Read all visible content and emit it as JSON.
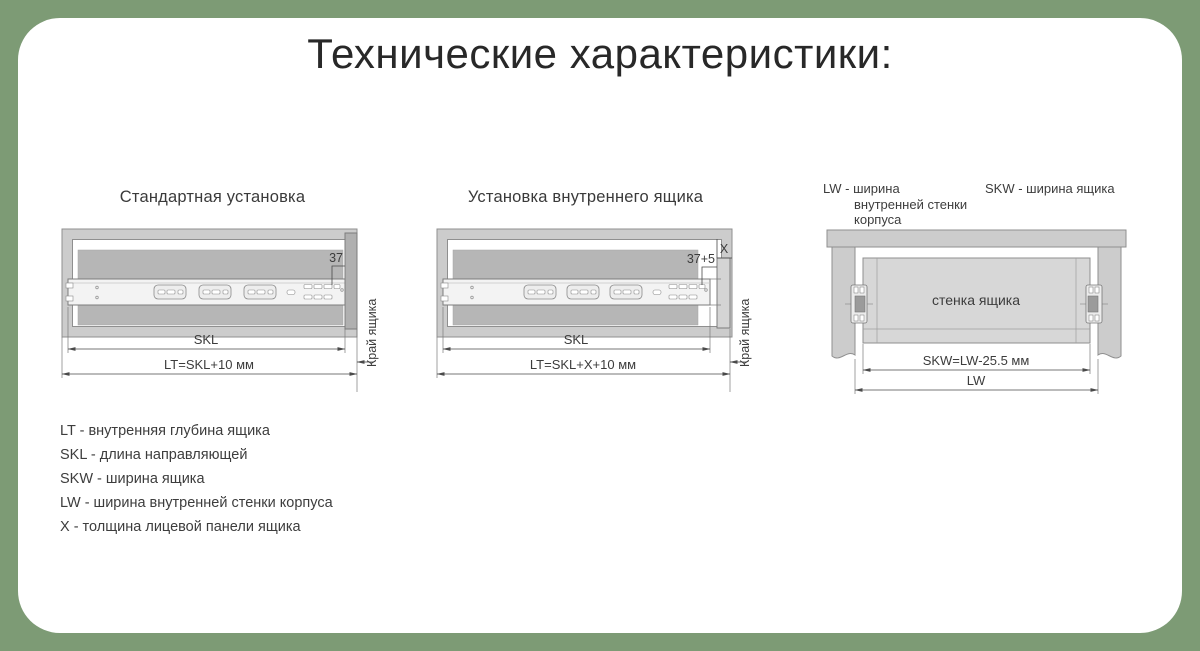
{
  "title": "Технические характеристики:",
  "colors": {
    "background": "#7d9b75",
    "card": "#ffffff",
    "frame_gray": "#cccccc",
    "panel_gray": "#b6b6b6",
    "dim_line": "#4a4a4a"
  },
  "diagrams": {
    "standard": {
      "title": "Стандартная установка",
      "offset_dim": "37",
      "skl_dim": "SKL",
      "lt_dim": "LT=SKL+10 мм",
      "edge_label": "Край ящика"
    },
    "inner": {
      "title": "Установка внутреннего ящика",
      "offset_dim": "37+5",
      "x_dim": "X",
      "skl_dim": "SKL",
      "lt_dim": "LT=SKL+X+10 мм",
      "edge_label": "Край ящика"
    },
    "width": {
      "lw_label_lines": [
        "LW - ширина",
        "внутренней стенки",
        "корпуса"
      ],
      "skw_label": "SKW - ширина ящика",
      "drawer_wall_label": "стенка ящика",
      "skw_dim": "SKW=LW-25.5 мм",
      "lw_dim": "LW"
    }
  },
  "legend": [
    "LT - внутренняя глубина ящика",
    "SKL - длина направляющей",
    "SKW - ширина ящика",
    "LW - ширина внутренней стенки корпуса",
    "X - толщина лицевой панели ящика"
  ]
}
